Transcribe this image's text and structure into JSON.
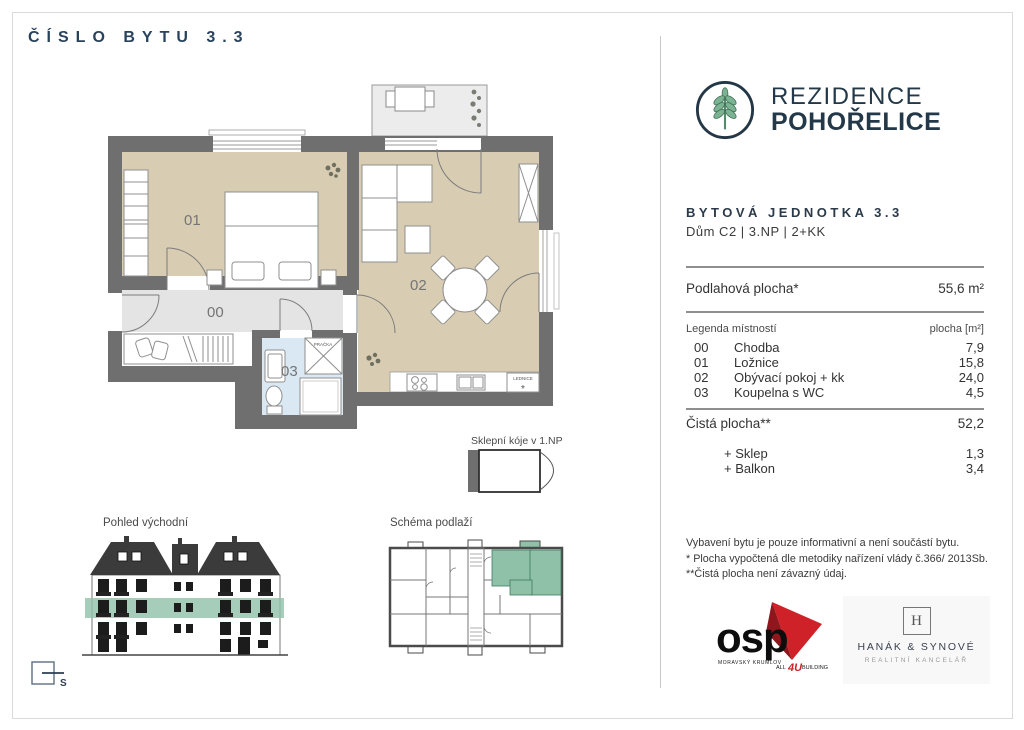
{
  "page": {
    "title": "ČÍSLO BYTU 3.3",
    "compass": "S"
  },
  "brand": {
    "line1": "REZIDENCE",
    "line2": "POHOŘELICE"
  },
  "unit": {
    "heading": "BYTOVÁ JEDNOTKA 3.3",
    "sub": "Dům C2  |  3.NP  |  2+KK"
  },
  "areas": {
    "floor_label": "Podlahová plocha*",
    "floor_value": "55,6 m²",
    "net_label": "Čistá plocha**",
    "net_value": "52,2",
    "extras": [
      {
        "label": "+ Sklep",
        "value": "1,3"
      },
      {
        "label": "+ Balkon",
        "value": "3,4"
      }
    ]
  },
  "legend": {
    "header_left": "Legenda místností",
    "header_right": "plocha [m²]",
    "rows": [
      {
        "code": "00",
        "name": "Chodba",
        "area": "7,9"
      },
      {
        "code": "01",
        "name": "Ložnice",
        "area": "15,8"
      },
      {
        "code": "02",
        "name": "Obývací pokoj + kk",
        "area": "24,0"
      },
      {
        "code": "03",
        "name": "Koupelna s WC",
        "area": "4,5"
      }
    ]
  },
  "notes": [
    "Vybavení bytu je pouze informativní a není součástí bytu.",
    "* Plocha vypočtená dle metodiky nařízení vlády č.366/ 2013Sb.",
    "**Čistá plocha není závazný údaj."
  ],
  "plan": {
    "room00": "00",
    "room01": "01",
    "room02": "02",
    "room03": "03",
    "washer": "PRAČKA",
    "fridge": "LEDNICE",
    "fridge_mark": "*",
    "cellar_label": "Sklepní kóje v 1.NP"
  },
  "sections": {
    "elevation": "Pohled východní",
    "schema": "Schéma podlaží"
  },
  "logos": {
    "osp": {
      "name": "osp",
      "city": "MORAVSKÝ KRUMLOV",
      "tag_pre": "ALL",
      "tag_num": "4U",
      "tag_post": "BUILDING"
    },
    "hanak": {
      "monogram": "H",
      "name": "HANÁK & SYNOVÉ",
      "sub": "REALITNÍ KANCELÁŘ"
    }
  },
  "colors": {
    "navy": "#29435c",
    "accent_green": "#7cb393",
    "highlight_green": "#8fc0a8",
    "wall_gray": "#6f6f6f",
    "room_beige": "#d8ccb2",
    "bath_blue": "#d9e8f2",
    "osp_red": "#cf2128"
  }
}
